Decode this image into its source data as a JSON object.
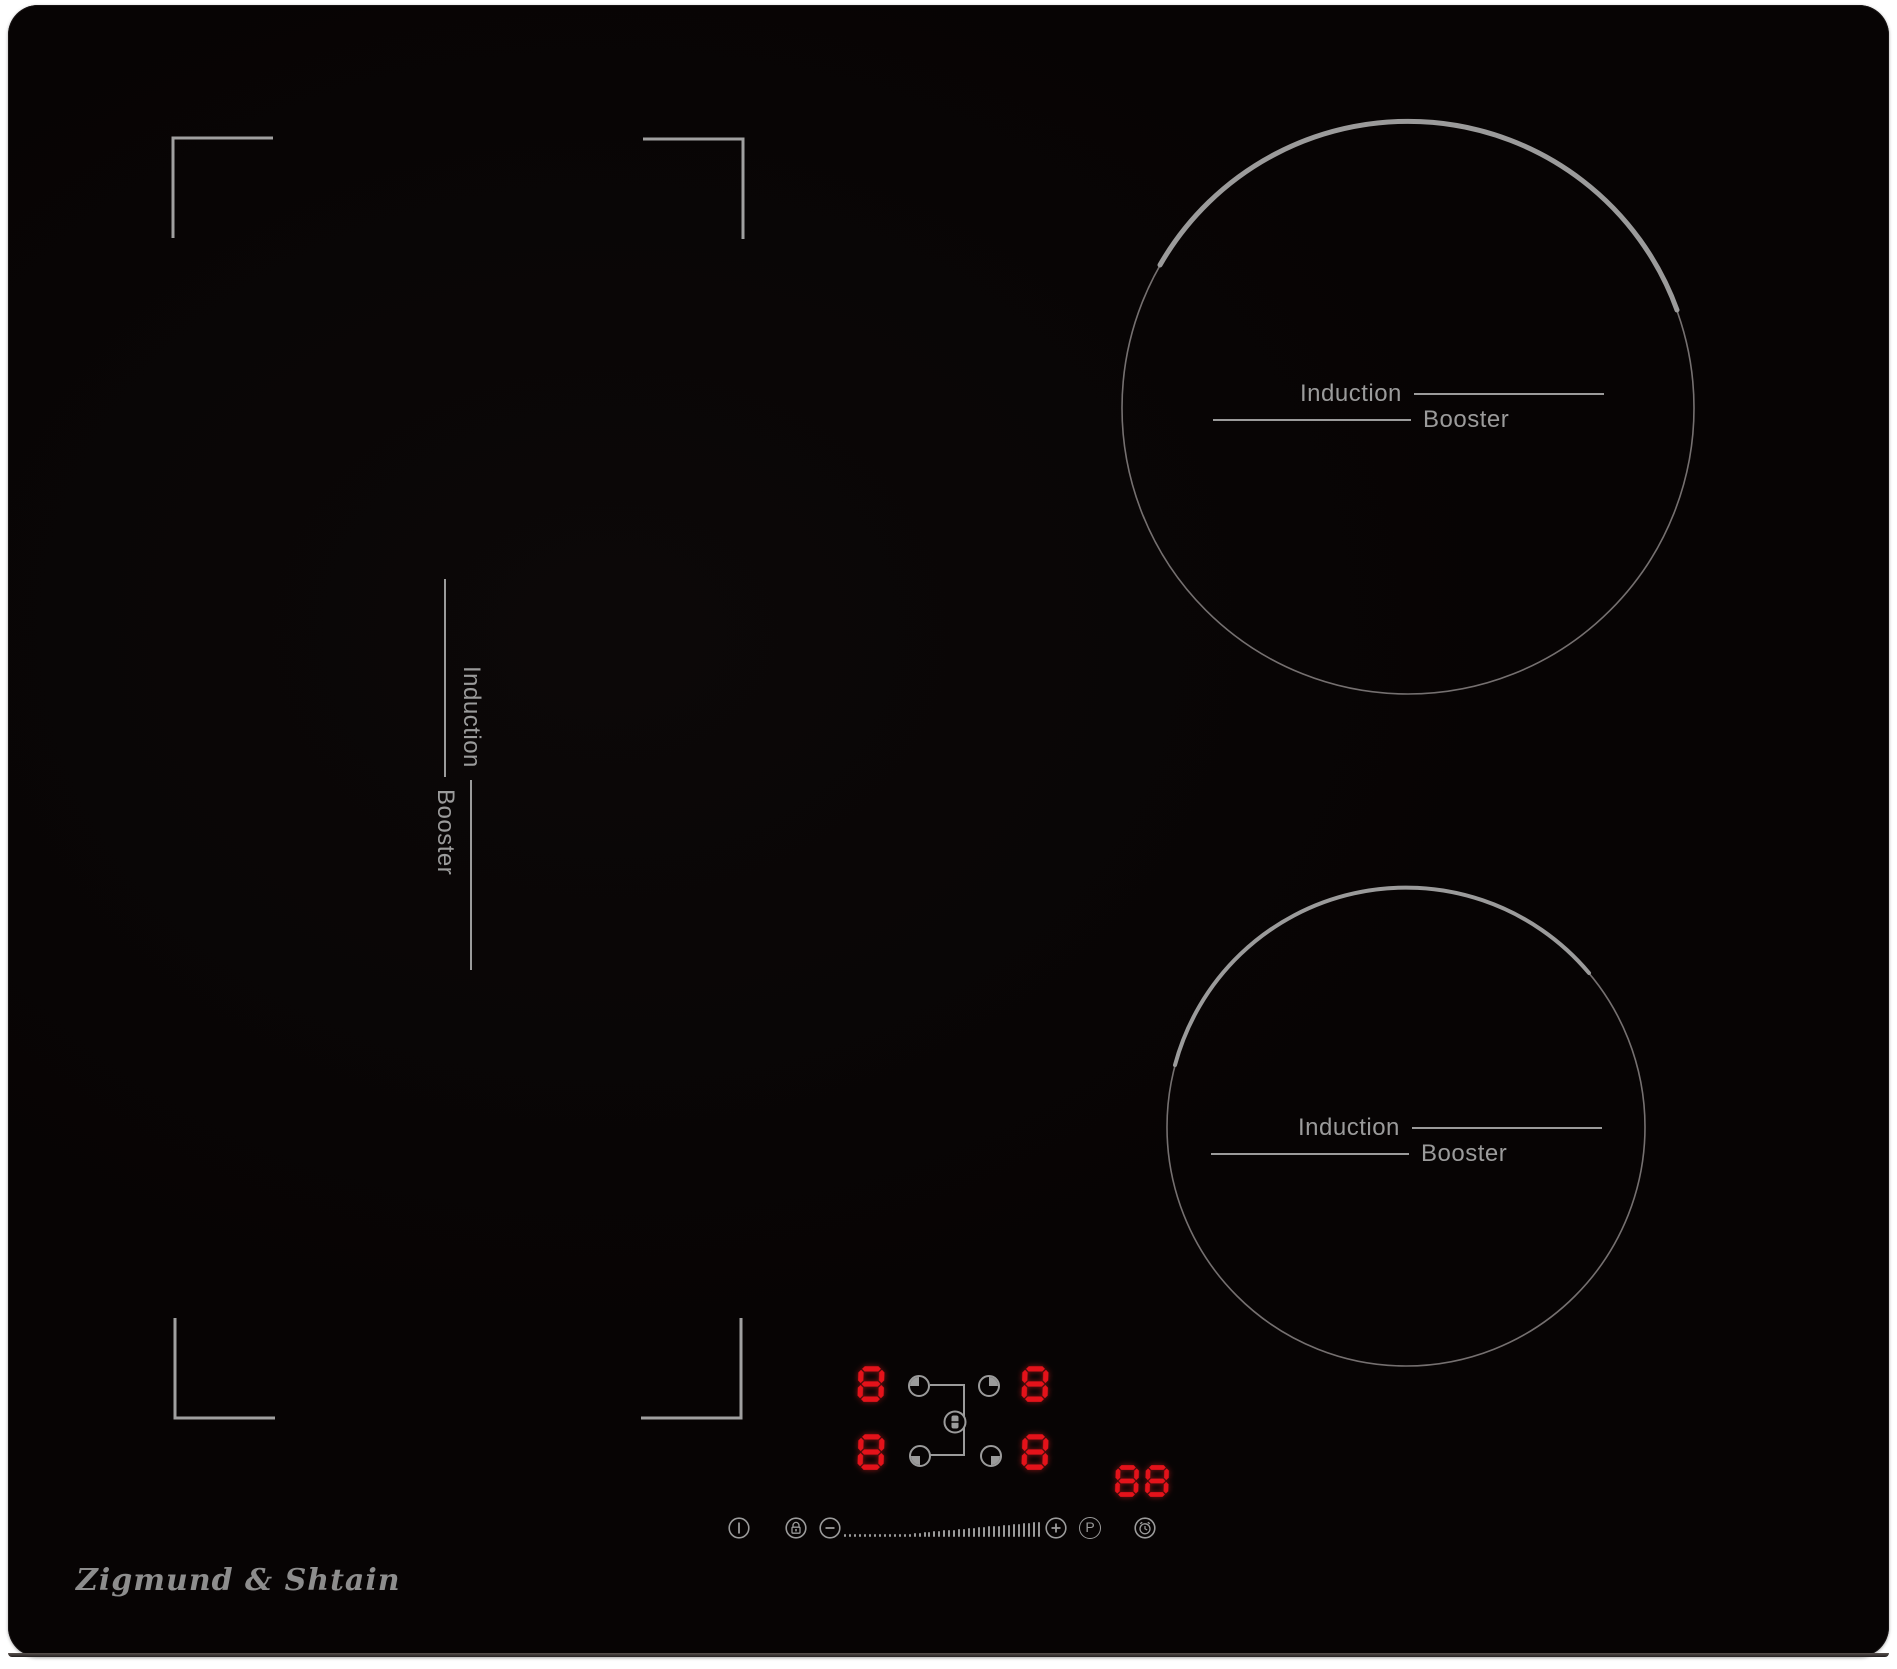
{
  "brand": {
    "logo_text": "Zigmund & Shtain"
  },
  "zone_labels": {
    "induction": "Induction",
    "booster": "Booster"
  },
  "displays": {
    "rear_left": "8",
    "rear_right": "8",
    "front_left": "8",
    "front_right": "8",
    "timer": "88"
  },
  "controls": {
    "power_icon": "standby-power",
    "lock_icon": "key-lock-padlock",
    "minus_icon": "minus",
    "plus_icon": "plus",
    "boost_label": "P",
    "timer_icon": "alarm-clock",
    "bridge_icon": "bridge-pot",
    "zone_indicator_icons": [
      "quarter-top-left",
      "quarter-top-right",
      "quarter-bottom-left",
      "quarter-bottom-right"
    ],
    "slider_tick_count": 40
  },
  "colors": {
    "display_red": "#e4121a",
    "icon_gray": "#9b9b9b",
    "circle_gray": "#787272",
    "surface_black": "#080505",
    "logo_gray": "#8d8d8d"
  }
}
